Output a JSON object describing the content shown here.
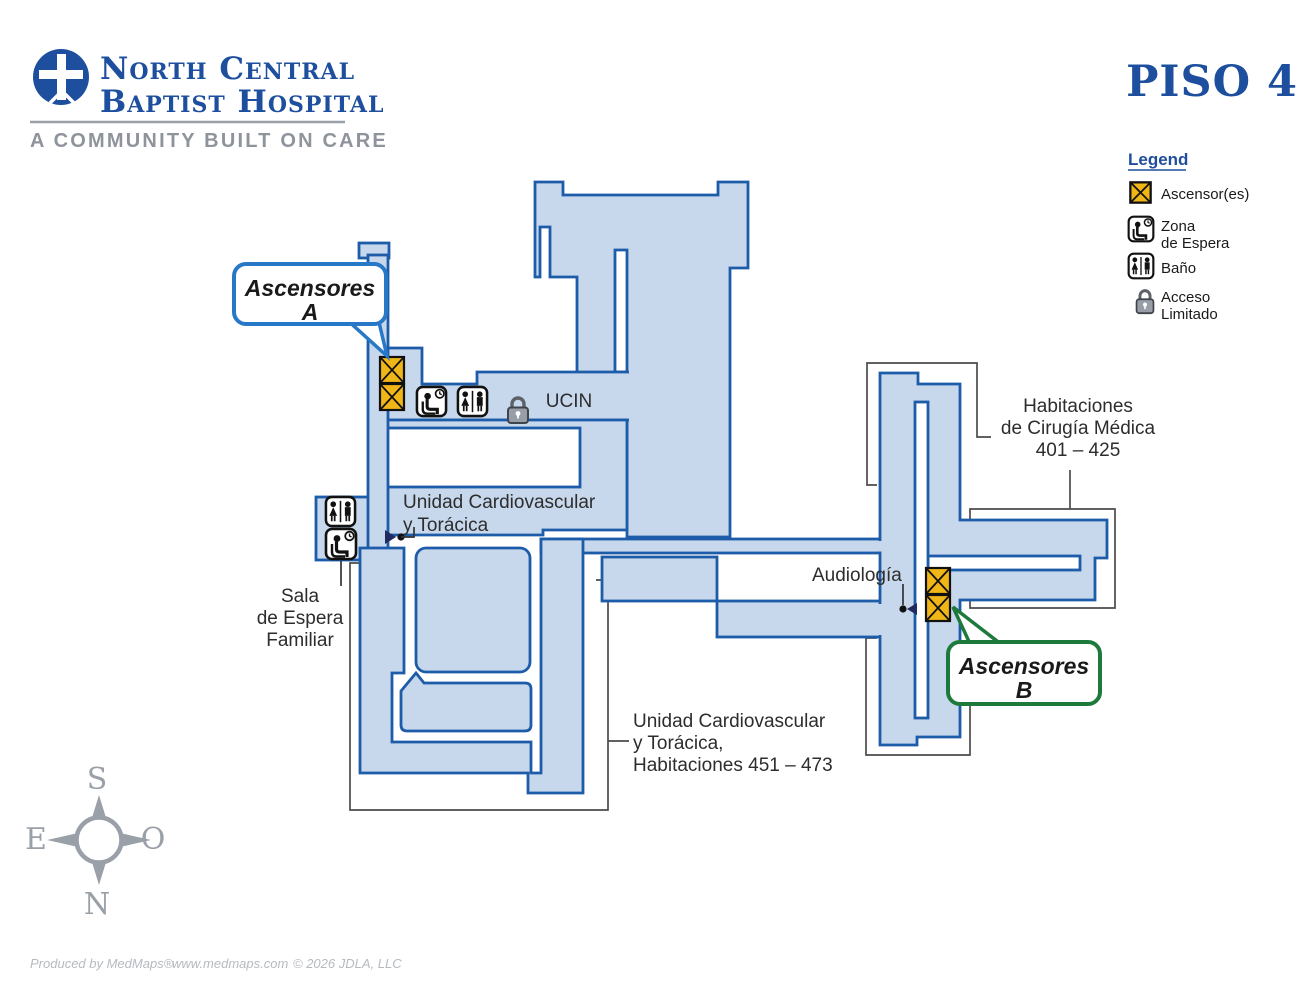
{
  "header": {
    "line1": "North Central",
    "line2": "Baptist Hospital",
    "tagline": "A COMMUNITY BUILT ON CARE",
    "floor_title": "PISO 4"
  },
  "legend": {
    "title": "Legend",
    "items": [
      {
        "icon": "elevator-icon",
        "label": "Ascensor(es)"
      },
      {
        "icon": "waiting-area-icon",
        "label_line1": "Zona",
        "label_line2": "de Espera"
      },
      {
        "icon": "restroom-icon",
        "label": "Baño"
      },
      {
        "icon": "lock-icon",
        "label_line1": "Acceso",
        "label_line2": "Limitado"
      }
    ]
  },
  "map": {
    "callouts": {
      "a_line1": "Ascensores",
      "a_line2": "A",
      "b_line1": "Ascensores",
      "b_line2": "B"
    },
    "labels": {
      "ucin": "UCIN",
      "unidad_cardio_line1": "Unidad Cardiovascular",
      "unidad_cardio_line2": "y Torácica",
      "sala_line1": "Sala",
      "sala_line2": "de Espera",
      "sala_line3": "Familiar",
      "audiologia": "Audiología",
      "habitaciones_line1": "Habitaciones",
      "habitaciones_line2": "de Cirugía Médica",
      "habitaciones_line3": "401 – 425",
      "unidad_hab_line1": "Unidad Cardiovascular",
      "unidad_hab_line2": "y Torácica,",
      "unidad_hab_line3": "Habitaciones 451 – 473"
    }
  },
  "compass": {
    "top": "S",
    "left": "E",
    "right": "O",
    "bottom": "N"
  },
  "footer": {
    "part1": "Produced by MedMaps®",
    "part2": "www.medmaps.com",
    "part3": "© 2026 JDLA, LLC"
  },
  "colors": {
    "map_fill": "#c7d7ec",
    "map_stroke": "#1d5ca9",
    "elevator_yellow": "#f0b517",
    "callout_a_border": "#2878c8",
    "callout_b_border": "#1e7a3c",
    "brand_blue": "#1d4f9e",
    "outline_gray": "#4b4b4b",
    "muted_gray": "#8f949c"
  }
}
